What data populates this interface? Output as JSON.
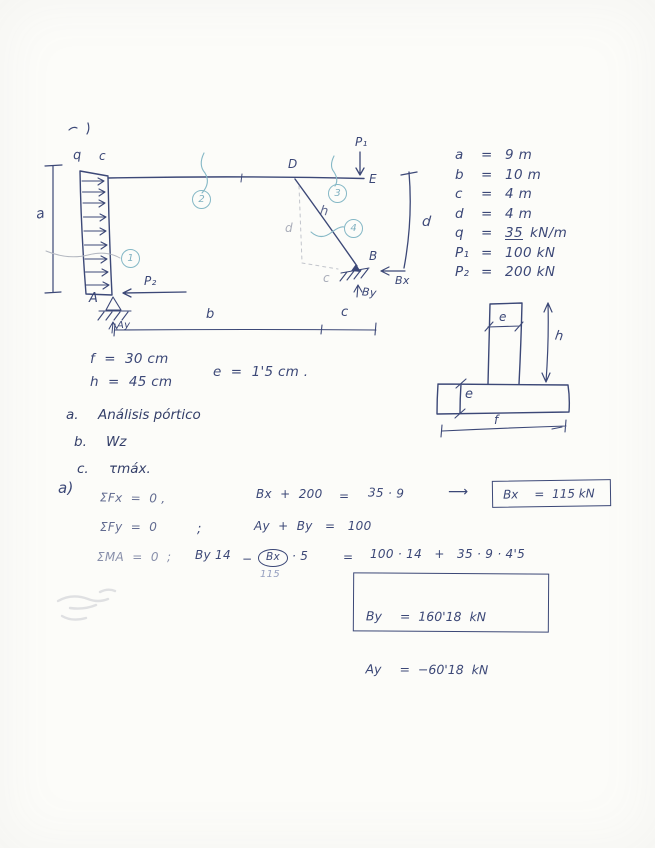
{
  "colors": {
    "ink": "#3c4877",
    "pencil": "#a9adb9",
    "marker": "#85b8c6",
    "paper": "#fcfcf9"
  },
  "frame": {
    "labels": {
      "q": "q",
      "c_top": "c",
      "a_dim": "a",
      "D": "D",
      "E": "E",
      "P1": "P₁",
      "P2": "P₂",
      "A": "A",
      "B": "B",
      "h": "h",
      "d_dim": "d",
      "d_pencil": "d",
      "c_pencil": "c",
      "Ay": "Ay",
      "By": "By",
      "Bx": "Bx",
      "b_dim": "b",
      "c_dim": "c"
    },
    "nodes": {
      "n1": "1",
      "n2": "2",
      "n3": "3",
      "n4": "4"
    }
  },
  "given": {
    "rows": [
      {
        "sym": "a",
        "eq": "=",
        "val": "9 m"
      },
      {
        "sym": "b",
        "eq": "=",
        "val": "10 m"
      },
      {
        "sym": "c",
        "eq": "=",
        "val": "4 m"
      },
      {
        "sym": "d",
        "eq": "=",
        "val": "4 m"
      },
      {
        "sym": "q",
        "eq": "=",
        "val": "35",
        "unit": "kN/m"
      },
      {
        "sym": "P₁",
        "eq": "=",
        "val": "100 kN"
      },
      {
        "sym": "P₂",
        "eq": "=",
        "val": "200 kN"
      }
    ]
  },
  "section": {
    "e_stem": "e",
    "h": "h",
    "e_flange": "e",
    "f": "f"
  },
  "dims": {
    "f": "f  =  30 cm",
    "h": "h  =  45 cm",
    "e": "e  =  1'5 cm ."
  },
  "tasks": [
    {
      "id": "a.",
      "text": "Análisis pórtico"
    },
    {
      "id": "b.",
      "text": "Wz"
    },
    {
      "id": "c.",
      "text": "τmáx."
    }
  ],
  "solution": {
    "part": "a)",
    "line1": {
      "lhs": "ΣFx  =  0 ,",
      "expr": "Bx  +  200",
      "eq": "=",
      "rhs": "35 · 9",
      "arrow": "⟶",
      "box_sym": "Bx",
      "box_val": "=  115 kN"
    },
    "line2": {
      "lhs": "ΣFy  =  0",
      "semi": ";",
      "expr": "Ay  +  By   =   100"
    },
    "line3": {
      "lhs": "ΣMA  =  0  ;",
      "t1": "By 14",
      "minus": "−",
      "circled": "Bx",
      "t2": "· 5",
      "sub": "115",
      "eq": "=",
      "rhs": "100 · 14   +   35 · 9 · 4'5"
    },
    "results": [
      {
        "sym": "By",
        "val": "=  160'18  kN"
      },
      {
        "sym": "Ay",
        "val": "=  −60'18  kN"
      }
    ]
  }
}
